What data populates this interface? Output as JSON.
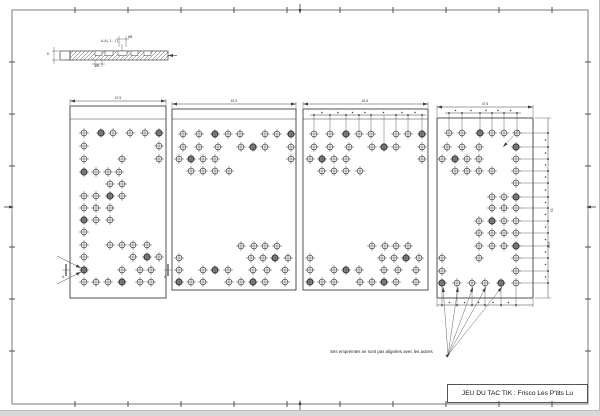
{
  "colors": {
    "line": "#3f3f3f",
    "frame": "#8f8f8f"
  },
  "frame": {
    "x": 12,
    "y": 10,
    "w": 576,
    "h": 394,
    "tick_xs": [
      75,
      128,
      181,
      234,
      287,
      340,
      393,
      446,
      499,
      552
    ],
    "tick_ys": [
      62,
      114,
      166,
      247,
      299,
      351
    ],
    "center_x": 300,
    "center_y": 207
  },
  "section_view": {
    "label": "A-A ( 1 : 1 )",
    "dim_top_label": "Ø8",
    "dim_bottom_label": "Ø5",
    "dim_left_label": "8",
    "cap": {
      "x": 60,
      "y": 51,
      "w": 10,
      "h": 9
    },
    "bar": {
      "x": 70,
      "y": 51,
      "w": 98,
      "h": 9
    },
    "notches": [
      [
        95,
        7
      ],
      [
        105,
        8
      ],
      [
        118,
        9
      ],
      [
        131,
        7
      ],
      [
        144,
        7
      ]
    ],
    "tail": {
      "x1": 168,
      "x2": 177
    },
    "label_leader_x": 122,
    "dim_top": {
      "x1": 119,
      "x2": 126,
      "y": 39
    },
    "dim_bottom": {
      "x1": 95,
      "x2": 102,
      "y": 64
    }
  },
  "panels": [
    {
      "name": "plate-1",
      "x": 70,
      "y": 106,
      "w": 96,
      "h": 192,
      "inner_top_line_y": 119,
      "dim": {
        "label": "47.5",
        "y": 101
      },
      "pointer_arrows": [
        [
          57,
          256,
          81,
          268
        ],
        [
          57,
          284,
          81,
          272
        ]
      ],
      "holes": [
        [
          84,
          133
        ],
        [
          101,
          133,
          1
        ],
        [
          113,
          133
        ],
        [
          130,
          133
        ],
        [
          145,
          133
        ],
        [
          159,
          133,
          1
        ],
        [
          84,
          146
        ],
        [
          159,
          146
        ],
        [
          84,
          159
        ],
        [
          122,
          159
        ],
        [
          159,
          159
        ],
        [
          84,
          172,
          1
        ],
        [
          96,
          172
        ],
        [
          108,
          172
        ],
        [
          119,
          172
        ],
        [
          110,
          184
        ],
        [
          122,
          184
        ],
        [
          84,
          196
        ],
        [
          96,
          196
        ],
        [
          110,
          196,
          1
        ],
        [
          122,
          196
        ],
        [
          84,
          208
        ],
        [
          96,
          208
        ],
        [
          110,
          208
        ],
        [
          84,
          220,
          1
        ],
        [
          96,
          220
        ],
        [
          110,
          220
        ],
        [
          84,
          232
        ],
        [
          84,
          245
        ],
        [
          110,
          245
        ],
        [
          122,
          245
        ],
        [
          133,
          245
        ],
        [
          147,
          245
        ],
        [
          84,
          257
        ],
        [
          133,
          257
        ],
        [
          147,
          257,
          1
        ],
        [
          159,
          257
        ],
        [
          84,
          270,
          1
        ],
        [
          122,
          270
        ],
        [
          140,
          270
        ],
        [
          151,
          270
        ],
        [
          84,
          282
        ],
        [
          96,
          282
        ],
        [
          108,
          282
        ],
        [
          122,
          282,
          1
        ],
        [
          140,
          282
        ],
        [
          151,
          282
        ]
      ]
    },
    {
      "name": "plate-2",
      "x": 172,
      "y": 109,
      "w": 124,
      "h": 181,
      "inner_top_line_y": 119,
      "dim": {
        "label": "61.5",
        "y": 104
      },
      "holes": [
        [
          183,
          134
        ],
        [
          199,
          134
        ],
        [
          215,
          134,
          1
        ],
        [
          228,
          134
        ],
        [
          240,
          134
        ],
        [
          265,
          134
        ],
        [
          277,
          134
        ],
        [
          291,
          134,
          1
        ],
        [
          183,
          147
        ],
        [
          199,
          147
        ],
        [
          218,
          147
        ],
        [
          241,
          147
        ],
        [
          253,
          147,
          1
        ],
        [
          265,
          147
        ],
        [
          291,
          147
        ],
        [
          179,
          159
        ],
        [
          191,
          159,
          1
        ],
        [
          203,
          159
        ],
        [
          215,
          159
        ],
        [
          291,
          159
        ],
        [
          191,
          171
        ],
        [
          203,
          171
        ],
        [
          215,
          171
        ],
        [
          229,
          171
        ],
        [
          241,
          246
        ],
        [
          254,
          246
        ],
        [
          265,
          246
        ],
        [
          277,
          246
        ],
        [
          179,
          258
        ],
        [
          251,
          258
        ],
        [
          263,
          258
        ],
        [
          275,
          258,
          1
        ],
        [
          288,
          258
        ],
        [
          179,
          270
        ],
        [
          203,
          270
        ],
        [
          215,
          270,
          1
        ],
        [
          228,
          270
        ],
        [
          253,
          270
        ],
        [
          267,
          270
        ],
        [
          285,
          270
        ],
        [
          179,
          282,
          1
        ],
        [
          191,
          282
        ],
        [
          203,
          282
        ],
        [
          229,
          282
        ],
        [
          241,
          282
        ],
        [
          253,
          282,
          1
        ],
        [
          265,
          282
        ],
        [
          285,
          282
        ]
      ]
    },
    {
      "name": "plate-3",
      "x": 303,
      "y": 109,
      "w": 125,
      "h": 181,
      "inner_top_line_y": 119,
      "dim": {
        "label": "61.5",
        "y": 104
      },
      "top_chain": {
        "y": 115,
        "xs": [
          314,
          330,
          346,
          359,
          371,
          396,
          408,
          422
        ],
        "leader_to_y": 129,
        "long_leader": {
          "x": 384,
          "to_y": 142
        }
      },
      "holes": [
        [
          314,
          134
        ],
        [
          330,
          134
        ],
        [
          346,
          134,
          1
        ],
        [
          359,
          134
        ],
        [
          371,
          134
        ],
        [
          396,
          134
        ],
        [
          408,
          134
        ],
        [
          422,
          134,
          1
        ],
        [
          314,
          147
        ],
        [
          330,
          147
        ],
        [
          349,
          147
        ],
        [
          372,
          147
        ],
        [
          384,
          147,
          1
        ],
        [
          396,
          147
        ],
        [
          422,
          147
        ],
        [
          310,
          159
        ],
        [
          322,
          159,
          1
        ],
        [
          334,
          159
        ],
        [
          346,
          159
        ],
        [
          422,
          159
        ],
        [
          322,
          171
        ],
        [
          334,
          171
        ],
        [
          346,
          171
        ],
        [
          360,
          171
        ],
        [
          372,
          246
        ],
        [
          385,
          246
        ],
        [
          396,
          246
        ],
        [
          408,
          246
        ],
        [
          310,
          258
        ],
        [
          382,
          258
        ],
        [
          394,
          258
        ],
        [
          406,
          258,
          1
        ],
        [
          419,
          258
        ],
        [
          310,
          270
        ],
        [
          334,
          270
        ],
        [
          346,
          270,
          1
        ],
        [
          359,
          270
        ],
        [
          384,
          270
        ],
        [
          398,
          270
        ],
        [
          416,
          270
        ],
        [
          310,
          282,
          1
        ],
        [
          322,
          282
        ],
        [
          334,
          282
        ],
        [
          360,
          282
        ],
        [
          372,
          282
        ],
        [
          384,
          282,
          1
        ],
        [
          396,
          282
        ],
        [
          416,
          282
        ]
      ]
    },
    {
      "name": "plate-4",
      "x": 437,
      "y": 118,
      "w": 96,
      "h": 180,
      "dim": {
        "label": "47.5",
        "y": 107
      },
      "top_chain": {
        "y": 113,
        "xs": [
          449,
          462,
          480,
          492,
          504,
          517
        ],
        "leader_to_y": 128
      },
      "diag_leader": [
        519,
        130,
        503,
        147
      ],
      "right_chain": {
        "x": 548,
        "from_x": 520,
        "ys": [
          133,
          147,
          159,
          171,
          183,
          197,
          208,
          221,
          233,
          246,
          258,
          271,
          283
        ],
        "label_overall": "94",
        "label_seg": "12.5"
      },
      "bottom_chain": {
        "y": 305,
        "xs": [
          442,
          457,
          472,
          485,
          501,
          516
        ],
        "ext_from_y": 288
      },
      "holes": [
        [
          449,
          133
        ],
        [
          462,
          133
        ],
        [
          480,
          133,
          1
        ],
        [
          492,
          133
        ],
        [
          504,
          133
        ],
        [
          517,
          133
        ],
        [
          447,
          147
        ],
        [
          462,
          147
        ],
        [
          479,
          147
        ],
        [
          516,
          147,
          1
        ],
        [
          442,
          159
        ],
        [
          455,
          159,
          1
        ],
        [
          467,
          159
        ],
        [
          479,
          159
        ],
        [
          516,
          159
        ],
        [
          455,
          171
        ],
        [
          467,
          171
        ],
        [
          479,
          171
        ],
        [
          492,
          171
        ],
        [
          516,
          171
        ],
        [
          516,
          183
        ],
        [
          492,
          197
        ],
        [
          504,
          197
        ],
        [
          516,
          197,
          1
        ],
        [
          492,
          208
        ],
        [
          504,
          208
        ],
        [
          516,
          208
        ],
        [
          479,
          221
        ],
        [
          492,
          221,
          1
        ],
        [
          504,
          221
        ],
        [
          516,
          221
        ],
        [
          479,
          233
        ],
        [
          492,
          233
        ],
        [
          504,
          233
        ],
        [
          516,
          233
        ],
        [
          479,
          246
        ],
        [
          492,
          246
        ],
        [
          504,
          246
        ],
        [
          516,
          246,
          1
        ],
        [
          442,
          258
        ],
        [
          479,
          258
        ],
        [
          516,
          258
        ],
        [
          442,
          271
        ],
        [
          516,
          271
        ],
        [
          442,
          283,
          1
        ],
        [
          457,
          283
        ],
        [
          472,
          283
        ],
        [
          485,
          283
        ],
        [
          501,
          283,
          1
        ],
        [
          516,
          283
        ]
      ]
    }
  ],
  "section_markers": [
    {
      "x": 66,
      "y": 270,
      "label": "A"
    },
    {
      "x": 168,
      "y": 270,
      "label": "A"
    }
  ],
  "note": {
    "text": "Ses empreintes ne sont pas alignées avec les autres",
    "anchor": [
      448,
      355
    ],
    "targets": [
      [
        443,
        287
      ],
      [
        458,
        287
      ],
      [
        473,
        287
      ],
      [
        486,
        287
      ],
      [
        502,
        287
      ]
    ]
  },
  "title_block": {
    "title": "JEU DU TAC TIK : Frisco Les P'tits Lu"
  }
}
